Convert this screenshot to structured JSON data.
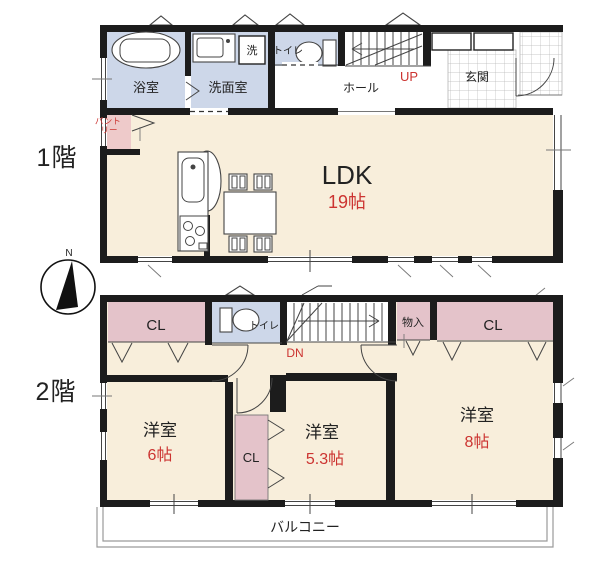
{
  "compass": {
    "north_label": "N"
  },
  "floor1": {
    "name": "1階",
    "bathroom": "浴室",
    "washroom": "洗面室",
    "laundry": "洗",
    "toilet": "トイレ",
    "hall": "ホール",
    "stairs_direction": "UP",
    "entrance": "玄関",
    "pantry_line1": "パント",
    "pantry_line2": "リー",
    "living": "LDK",
    "living_size": "19帖"
  },
  "floor2": {
    "name": "2階",
    "closet_left": "CL",
    "toilet": "トイレ",
    "stairs_direction": "DN",
    "storage": "物入",
    "closet_right": "CL",
    "bedroom1": "洋室",
    "bedroom1_size": "6帖",
    "closet_mid": "CL",
    "bedroom2": "洋室",
    "bedroom2_size": "5.3帖",
    "bedroom3": "洋室",
    "bedroom3_size": "8帖",
    "balcony": "バルコニー"
  },
  "colors": {
    "room_fill": "#f8eedb",
    "wet_area_fill": "#cdd7e9",
    "closet_fill": "#e4c3ca",
    "pantry_fill": "#eecaca",
    "accent_red": "#cc3431",
    "wall": "#1c1c1c"
  }
}
